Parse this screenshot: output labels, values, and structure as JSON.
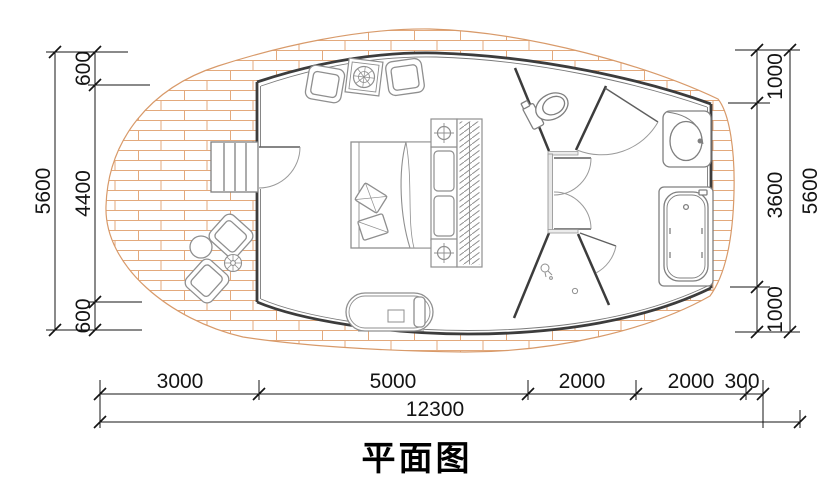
{
  "title": {
    "text": "平面图"
  },
  "dimensions": {
    "left": {
      "orientation": "vertical",
      "total": "5600",
      "segments": [
        "600",
        "4400",
        "600"
      ]
    },
    "right": {
      "orientation": "vertical",
      "total": "5600",
      "segments": [
        "1000",
        "3600",
        "1000"
      ]
    },
    "bottom": {
      "orientation": "horizontal",
      "total": "12300",
      "segments": [
        "3000",
        "5000",
        "2000",
        "2000",
        "300"
      ]
    }
  },
  "colors": {
    "brick_joint": "#e3a97c",
    "deck_outline": "#d89a6a",
    "wall": "#3c3c3c",
    "furniture": "#8f8f8f",
    "dimension": "#141414",
    "background": "#ffffff"
  }
}
